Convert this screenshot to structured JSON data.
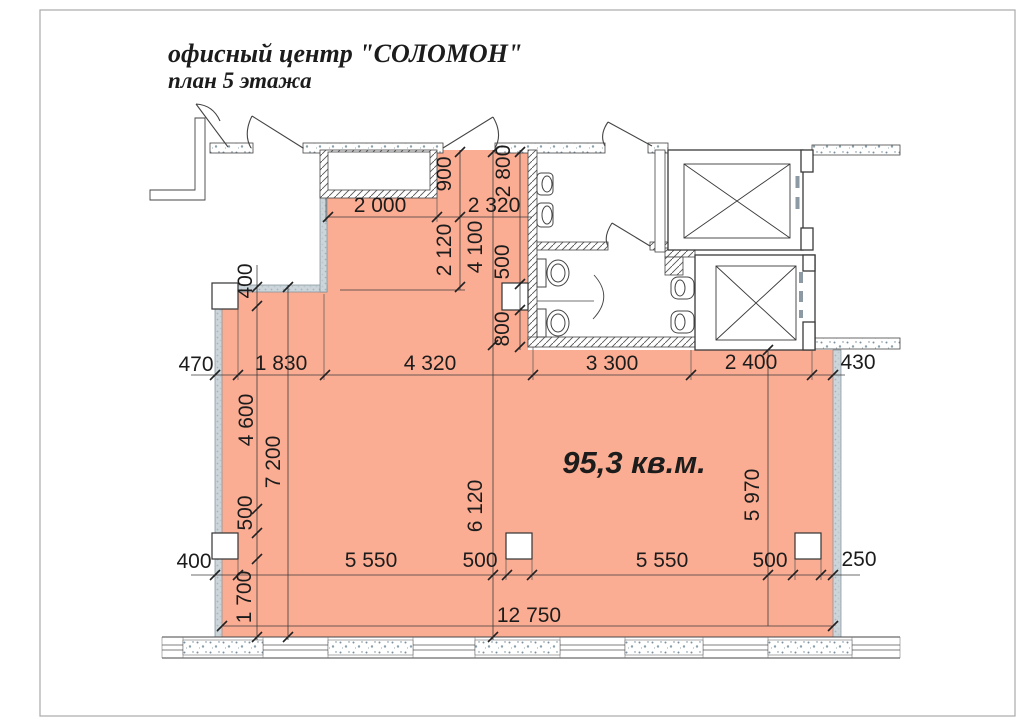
{
  "page": {
    "border_color": "#a9a9a9",
    "background": "#ffffff"
  },
  "title": {
    "line1": "офисный центр \"СОЛОМОН\"",
    "line2": "план 5 этажа",
    "color": "#8e1b13"
  },
  "plan": {
    "area_label": "95,3 кв.м.",
    "colors": {
      "area_fill": "#fbad93",
      "line": "#3c3c3c"
    },
    "dims": {
      "ext_left_row1": "470",
      "r1a": "1 830",
      "r1b": "4 320",
      "r1c": "3 300",
      "r1d": "2 400",
      "ext_right_row1": "430",
      "ext_left_row2": "400",
      "r2a": "5 550",
      "r2b": "500",
      "r2c": "5 550",
      "r2d": "500",
      "ext_right_row2": "250",
      "total_width": "12 750",
      "niche_w": "2 000",
      "top_right_w": "2 320",
      "col_top": "400",
      "v4600": "4 600",
      "v500": "500",
      "v1700": "1 700",
      "v7200": "7 200",
      "v900": "900",
      "v2120": "2 120",
      "v4100": "4 100",
      "v6120": "6 120",
      "v2800": "2 800",
      "v500u": "500",
      "v800": "800",
      "v5970": "5 970"
    }
  }
}
